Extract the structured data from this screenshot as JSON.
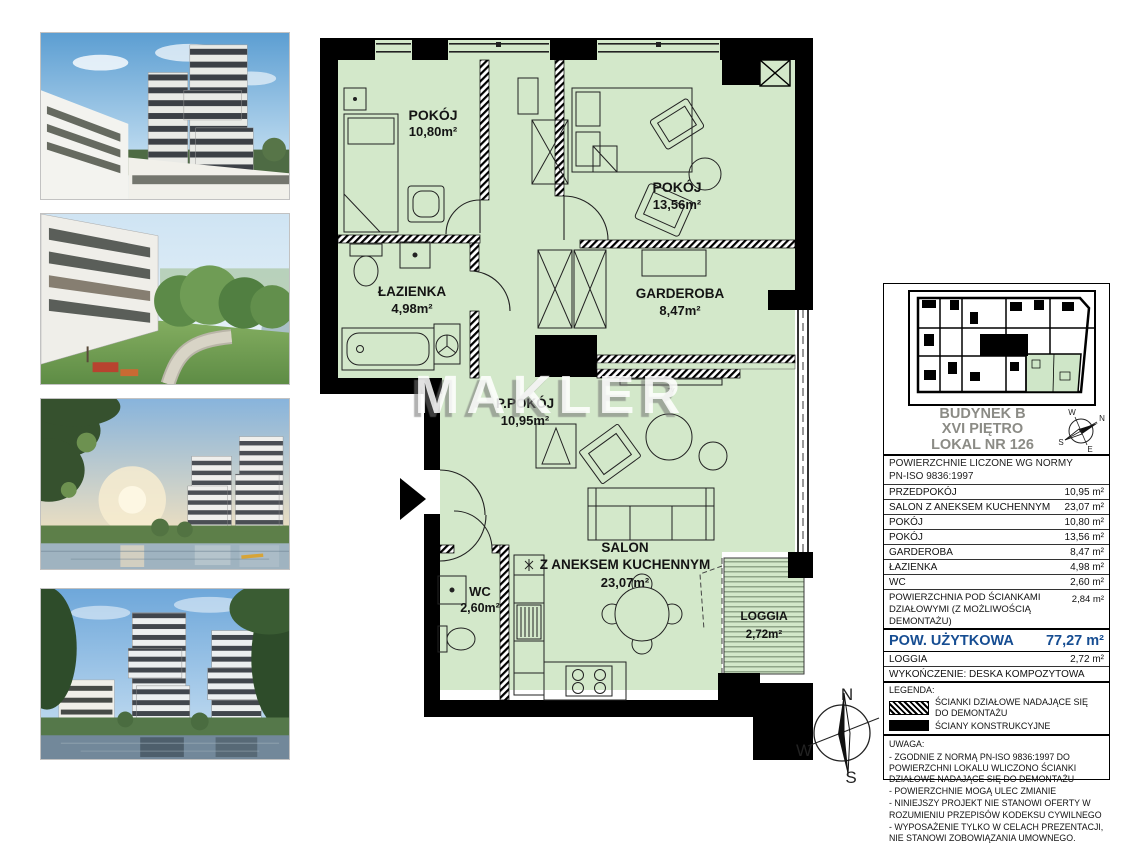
{
  "watermark": "MAKLER",
  "colors": {
    "plan_green": "#d3e8ca",
    "accent_blue": "#164d92",
    "wall_black": "#000000"
  },
  "plan": {
    "rooms": [
      {
        "name": "POKÓJ",
        "area": "10,80m²"
      },
      {
        "name": "POKÓJ",
        "area": "13,56m²"
      },
      {
        "name": "ŁAZIENKA",
        "area": "4,98m²"
      },
      {
        "name": "GARDEROBA",
        "area": "8,47m²"
      },
      {
        "name": "P.POKÓJ",
        "area": "10,95m²"
      },
      {
        "name": "SALON",
        "name2": "Z ANEKSEM KUCHENNYM",
        "area": "23,07m²"
      },
      {
        "name": "WC",
        "area": "2,60m²"
      },
      {
        "name": "LOGGIA",
        "area": "2,72m²"
      }
    ],
    "tv_label": "TV"
  },
  "compass": {
    "n": "N",
    "e": "E",
    "s": "S",
    "w": "W"
  },
  "panel": {
    "header": {
      "building": "BUDYNEK B",
      "floor": "XVI PIĘTRO",
      "unit": "LOKAL NR 126"
    },
    "norm_line1": "POWIERZCHNIE LICZONE WG NORMY",
    "norm_line2": "PN-ISO 9836:1997",
    "rows": [
      {
        "label": "PRZEDPOKÓJ",
        "value": "10,95 m²"
      },
      {
        "label": "SALON Z ANEKSEM KUCHENNYM",
        "value": "23,07 m²"
      },
      {
        "label": "POKÓJ",
        "value": "10,80 m²"
      },
      {
        "label": "POKÓJ",
        "value": "13,56 m²"
      },
      {
        "label": "GARDEROBA",
        "value": "8,47 m²"
      },
      {
        "label": "ŁAZIENKA",
        "value": "4,98 m²"
      },
      {
        "label": "WC",
        "value": "2,60 m²"
      }
    ],
    "partition_row": {
      "label": "POWIERZCHNIA POD ŚCIANKAMI DZIAŁOWYMI (Z MOŻLIWOŚCIĄ DEMONTAŻU)",
      "value": "2,84 m²"
    },
    "total_row": {
      "label": "POW. UŻYTKOWA",
      "value": "77,27 m²"
    },
    "loggia_row": {
      "label": "LOGGIA",
      "value": "2,72 m²"
    },
    "finish_line": "WYKOŃCZENIE: DESKA KOMPOZYTOWA",
    "legend": {
      "title": "LEGENDA:",
      "item1": "ŚCIANKI DZIAŁOWE NADAJĄCE SIĘ DO DEMONTAŻU",
      "item2": "ŚCIANY KONSTRUKCYJNE"
    },
    "uwaga": {
      "title": "UWAGA:",
      "note1": "- ZGODNIE Z NORMĄ PN-ISO 9836:1997 DO POWIERZCHNI LOKALU WLICZONO ŚCIANKI DZIAŁOWE NADAJĄCE SIĘ DO DEMONTAŻU",
      "note2": "- POWIERZCHNIE MOGĄ ULEC ZMIANIE",
      "note3": "- NINIEJSZY PROJEKT NIE STANOWI OFERTY W ROZUMIENIU PRZEPISÓW KODEKSU CYWILNEGO",
      "note4": "- WYPOSAŻENIE TYLKO W CELACH PREZENTACJI, NIE STANOWI ZOBOWIĄZANIA UMOWNEGO."
    }
  }
}
